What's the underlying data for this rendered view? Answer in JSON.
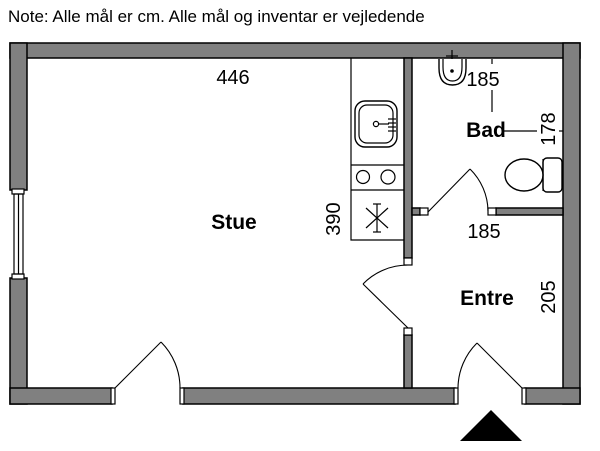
{
  "note": "Note: Alle mål er cm. Alle mål og inventar er vejledende",
  "rooms": {
    "stue": {
      "label": "Stue"
    },
    "bad": {
      "label": "Bad"
    },
    "entre": {
      "label": "Entre"
    }
  },
  "dimensions_cm": {
    "stue_width": "446",
    "kitchen_run": "390",
    "bad_width": "185",
    "bad_depth": "178",
    "entre_width": "185",
    "entre_depth": "205"
  },
  "fixtures": [
    "kitchen-sink-icon",
    "stove-burners-icon",
    "drain-asterisk-icon",
    "washbasin-icon",
    "toilet-icon",
    "window-icon",
    "door-swing-icon",
    "entrance-arrow-icon"
  ],
  "colors": {
    "wall_fill": "#808080",
    "line": "#000000",
    "background": "#ffffff"
  }
}
